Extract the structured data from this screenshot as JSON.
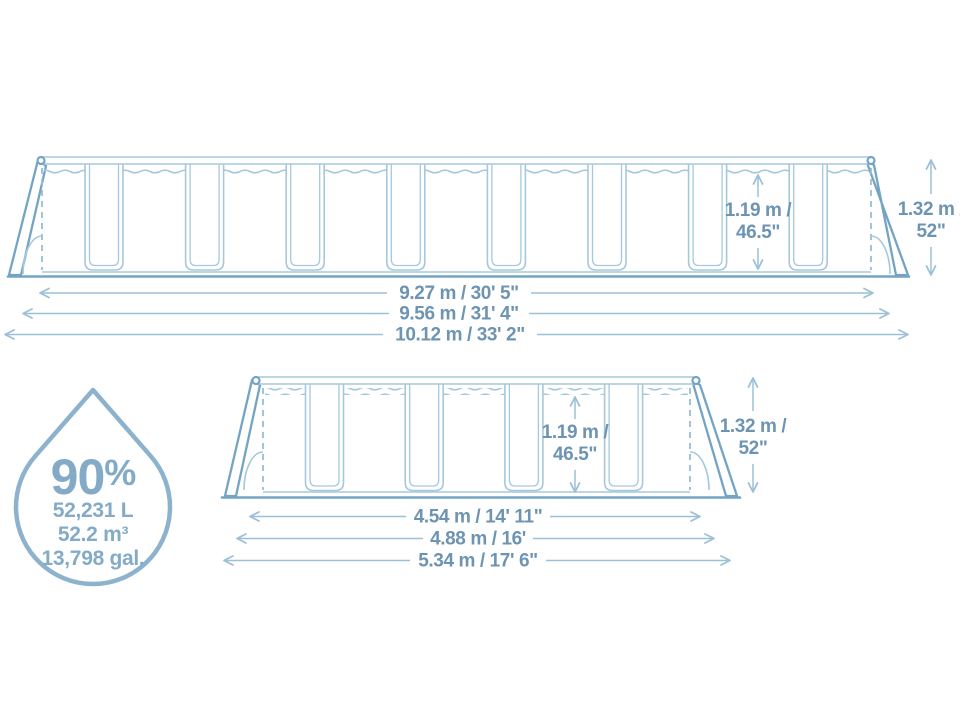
{
  "colors": {
    "line_light": "#a6c8dc",
    "line_accent": "#74a4c4",
    "dashed": "#98bdd4",
    "dim_line": "#9cc0d6",
    "dim_text": "#6d94b2",
    "drop_outline": "#8cb2cd",
    "drop_text": "#83abc8"
  },
  "top_pool": {
    "wall_height_metric": "1.19 m /",
    "wall_height_imperial": "46.5\"",
    "frame_height_metric": "1.32 m /",
    "frame_height_imperial": "52\"",
    "lengths": [
      {
        "label": "9.27 m / 30' 5\""
      },
      {
        "label": "9.56 m / 31' 4\""
      },
      {
        "label": "10.12 m / 33' 2\""
      }
    ]
  },
  "bottom_pool": {
    "wall_height_metric": "1.19 m /",
    "wall_height_imperial": "46.5\"",
    "frame_height_metric": "1.32 m /",
    "frame_height_imperial": "52\"",
    "lengths": [
      {
        "label": "4.54 m / 14' 11\""
      },
      {
        "label": "4.88 m / 16'"
      },
      {
        "label": "5.34 m / 17' 6\""
      }
    ]
  },
  "capacity": {
    "percent_value": "90",
    "percent_sign": "%",
    "liters": "52,231 L",
    "cubic_meters": "52.2 m³",
    "gallons": "13,798 gal."
  }
}
